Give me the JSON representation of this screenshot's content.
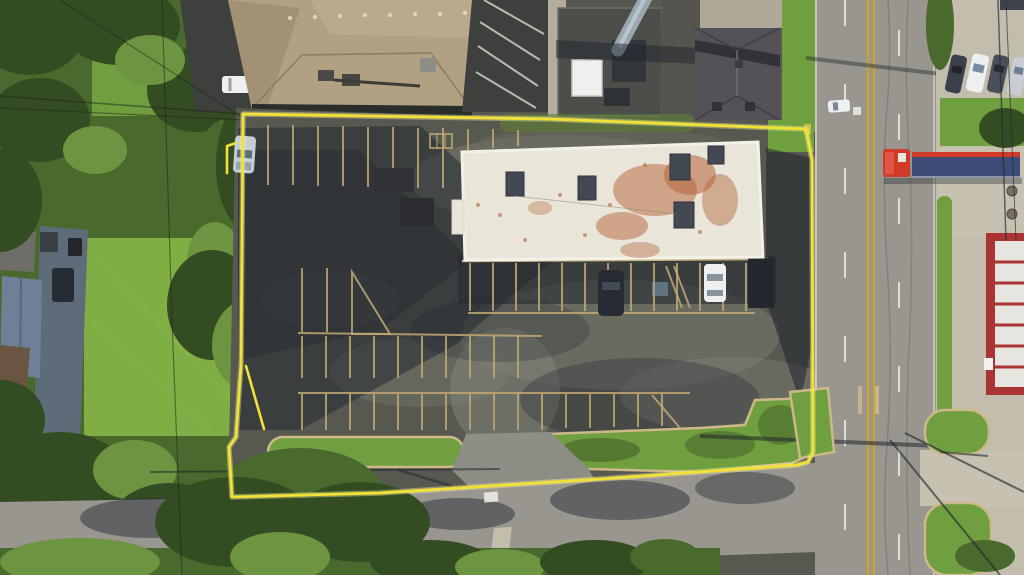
{
  "scene": {
    "type": "aerial-photograph",
    "subject": "overhead drone view of a commercial parcel outlined in yellow: flat-roof retail building with rust-stained white roof, worn asphalt parking lot with tan stall striping, bordered by a north-south arterial road with a red semi-truck, neighboring houses and trees to the west, grass medians and driveways to the south"
  },
  "boundary": {
    "color": "#f1e235",
    "glow": "#f8f3a0",
    "stroke_width": 3
  },
  "colors": {
    "boundary": "#f1e235",
    "boundaryGlow": "#f8f3a0",
    "lotAsphalt": "#57584f",
    "lotWorn": "#7b7c71",
    "asphaltDark": "#3d403c",
    "shadow": "#1f242e",
    "road": "#98968e",
    "roadCurb": "#d8d2c2",
    "centerline": "#c8a233",
    "laneWhite": "#eceade",
    "concrete": "#c3bdae",
    "curb": "#cdb88a",
    "stall": "#c2a873",
    "treeDark": "#344c22",
    "treeMid": "#4a692c",
    "treeLight": "#6d9440",
    "lawn": "#7fae45",
    "grass": "#6f9f3f",
    "roofTan": "#b2a083",
    "roofTanShade": "#9b8a6d",
    "roofWhite": "#eae5d9",
    "rust": "#b4633a",
    "hvac": "#424953",
    "roofHouse": "#545257",
    "equipYard": "#4b4e49",
    "stack": "#9aa6b1",
    "whiteBox": "#eef0ee",
    "driveway": "#5e6b78",
    "blueRoof": "#6e8095",
    "brownRoof": "#6a5542",
    "carWhite": "#edeff0",
    "carSilver": "#c7cdd3",
    "carDark": "#272c34",
    "carGray": "#6e7681",
    "truckRed": "#d23a28",
    "trailerBlue": "#3d4b76",
    "redBuilding": "#a93434",
    "panelWhite": "#e7e5df"
  }
}
